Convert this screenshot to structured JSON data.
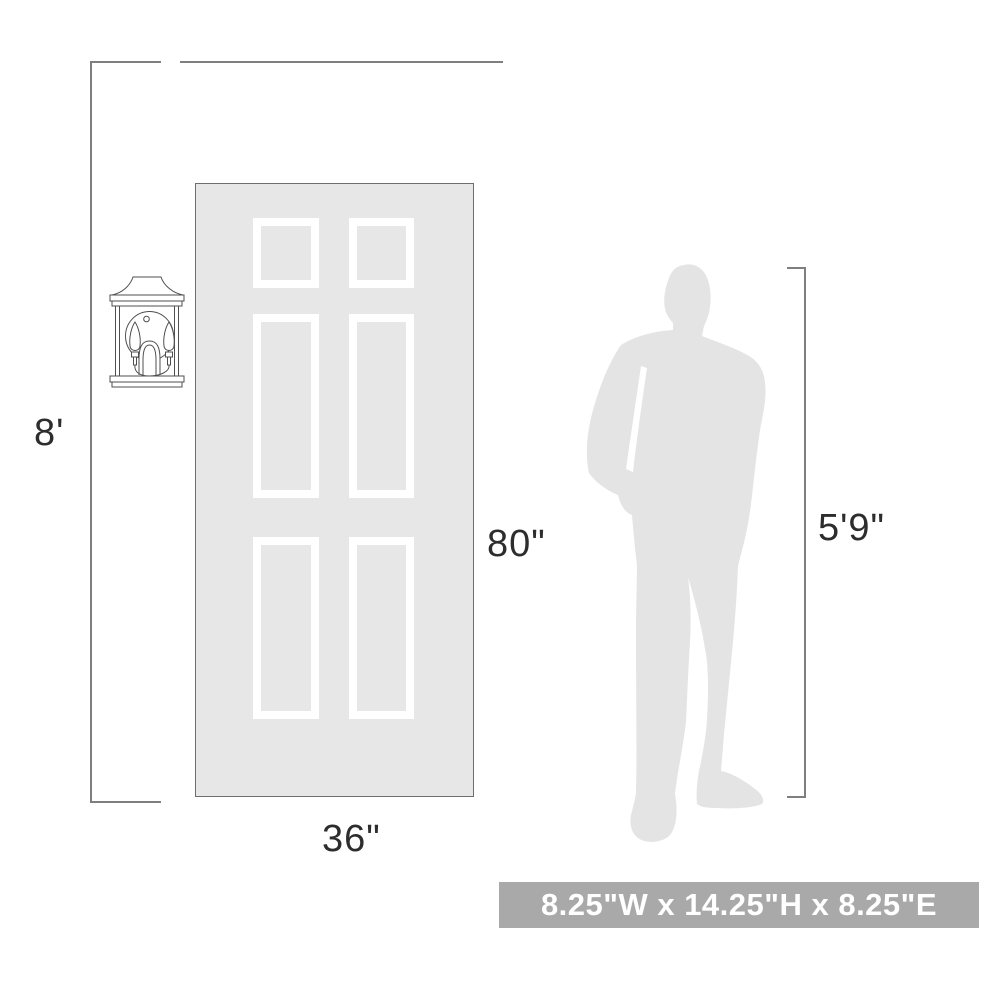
{
  "diagram": {
    "title": "Wall sconce mounting-scale diagram",
    "wall": {
      "height_label": "8'"
    },
    "door": {
      "height_label": "80\"",
      "width_label": "36\""
    },
    "person": {
      "height_label": "5'9\""
    },
    "banner_text": "8.25\"W x 14.25\"H x 8.25\"E"
  },
  "icons": {
    "sconce": "outdoor-wall-lantern-line-art",
    "person": "standing-man-silhouette"
  },
  "colors": {
    "door_fill": "#e7e7e7",
    "panel_frame": "#ffffff",
    "silhouette_fill": "#e4e4e4",
    "line_color": "#7f7f7f",
    "text_color": "#2d2d2d",
    "banner_bg": "#a9a9a9",
    "banner_text": "#ffffff",
    "sconce_stroke": "#4f4f4f",
    "door_border": "#6e6e6e"
  }
}
